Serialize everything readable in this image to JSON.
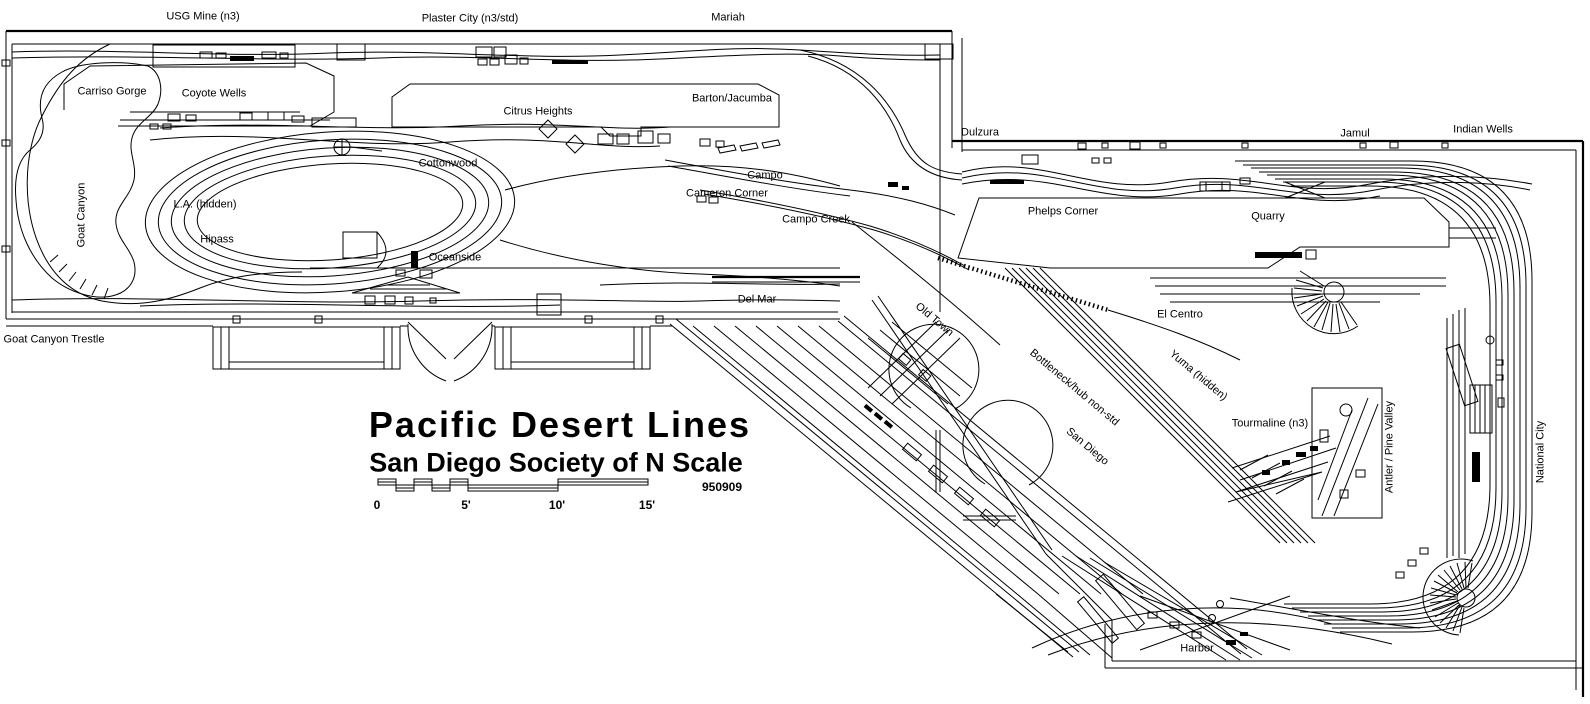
{
  "colors": {
    "ink": "#000000",
    "paper": "#ffffff"
  },
  "title_block": {
    "title": "Pacific Desert Lines",
    "subtitle": "San Diego Society of N Scale",
    "revision": "950909"
  },
  "scale_bar": {
    "label_y": 505,
    "ticks": [
      {
        "label": "0",
        "x": 377
      },
      {
        "label": "5'",
        "x": 466
      },
      {
        "label": "10'",
        "x": 557
      },
      {
        "label": "15'",
        "x": 647
      }
    ]
  },
  "labels": [
    {
      "id": "usg-mine",
      "text": "USG Mine (n3)",
      "x": 203,
      "y": 17,
      "rot": 0
    },
    {
      "id": "plaster-city",
      "text": "Plaster City (n3/std)",
      "x": 470,
      "y": 19,
      "rot": 0
    },
    {
      "id": "mariah",
      "text": "Mariah",
      "x": 728,
      "y": 18,
      "rot": 0
    },
    {
      "id": "dulzura",
      "text": "Dulzura",
      "x": 980,
      "y": 133,
      "rot": 0
    },
    {
      "id": "jamul",
      "text": "Jamul",
      "x": 1355,
      "y": 134,
      "rot": 0
    },
    {
      "id": "indian-wells",
      "text": "Indian Wells",
      "x": 1483,
      "y": 130,
      "rot": 0
    },
    {
      "id": "carriso-gorge",
      "text": "Carriso Gorge",
      "x": 112,
      "y": 92,
      "rot": 0
    },
    {
      "id": "coyote-wells",
      "text": "Coyote Wells",
      "x": 214,
      "y": 94,
      "rot": 0
    },
    {
      "id": "goat-canyon",
      "text": "Goat Canyon",
      "x": 82,
      "y": 215,
      "rot": -90
    },
    {
      "id": "la-hidden",
      "text": "L.A. (hidden)",
      "x": 205,
      "y": 205,
      "rot": 0
    },
    {
      "id": "hipass",
      "text": "Hipass",
      "x": 217,
      "y": 240,
      "rot": 0
    },
    {
      "id": "goat-canyon-trestle",
      "text": "Goat Canyon Trestle",
      "x": 54,
      "y": 340,
      "rot": 0
    },
    {
      "id": "citrus-heights",
      "text": "Citrus Heights",
      "x": 538,
      "y": 112,
      "rot": 0
    },
    {
      "id": "barton-jacumba",
      "text": "Barton/Jacumba",
      "x": 732,
      "y": 99,
      "rot": 0
    },
    {
      "id": "cottonwood",
      "text": "Cottonwood",
      "x": 448,
      "y": 164,
      "rot": 0
    },
    {
      "id": "campo",
      "text": "Campo",
      "x": 765,
      "y": 176,
      "rot": 0
    },
    {
      "id": "cameron-corner",
      "text": "Cameron Corner",
      "x": 727,
      "y": 194,
      "rot": 0
    },
    {
      "id": "campo-creek",
      "text": "Campo Creek",
      "x": 816,
      "y": 220,
      "rot": 0
    },
    {
      "id": "oceanside",
      "text": "Oceanside",
      "x": 455,
      "y": 258,
      "rot": 0
    },
    {
      "id": "del-mar",
      "text": "Del Mar",
      "x": 757,
      "y": 300,
      "rot": 0
    },
    {
      "id": "old-town",
      "text": "Old Town",
      "x": 934,
      "y": 320,
      "rot": 40
    },
    {
      "id": "el-centro",
      "text": "El Centro",
      "x": 1180,
      "y": 315,
      "rot": 0
    },
    {
      "id": "yuma-hidden",
      "text": "Yuma (hidden)",
      "x": 1198,
      "y": 376,
      "rot": 40
    },
    {
      "id": "bottleneck",
      "text": "Bottleneck/hub non-std",
      "x": 1074,
      "y": 388,
      "rot": 40
    },
    {
      "id": "san-diego",
      "text": "San Diego",
      "x": 1087,
      "y": 447,
      "rot": 40
    },
    {
      "id": "tourmaline",
      "text": "Tourmaline (n3)",
      "x": 1270,
      "y": 424,
      "rot": 0
    },
    {
      "id": "antler-pine-valley",
      "text": "Antler / Pine Valley",
      "x": 1390,
      "y": 447,
      "rot": -90
    },
    {
      "id": "national-city",
      "text": "National City",
      "x": 1541,
      "y": 452,
      "rot": -90
    },
    {
      "id": "phelps-corner",
      "text": "Phelps Corner",
      "x": 1063,
      "y": 212,
      "rot": 0
    },
    {
      "id": "quarry",
      "text": "Quarry",
      "x": 1268,
      "y": 217,
      "rot": 0
    },
    {
      "id": "harbor",
      "text": "Harbor",
      "x": 1197,
      "y": 649,
      "rot": 0
    }
  ]
}
